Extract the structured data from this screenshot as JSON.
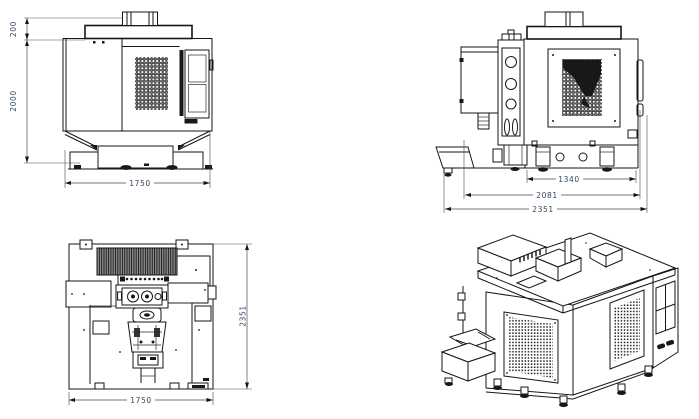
{
  "drawing": {
    "kind": "engineering-multiview",
    "subject": "vertical-machining-center",
    "colors": {
      "line": "#161616",
      "dim_text": "#33475f",
      "background": "#ffffff"
    },
    "views": {
      "front": {
        "dims": {
          "cap_height": "200",
          "height": "2000",
          "width": "1750"
        }
      },
      "side": {
        "dims": {
          "foot_span": "1340",
          "body_depth": "2081",
          "overall_depth": "2351"
        }
      },
      "plan": {
        "dims": {
          "depth": "2351",
          "width": "1750"
        }
      }
    }
  }
}
